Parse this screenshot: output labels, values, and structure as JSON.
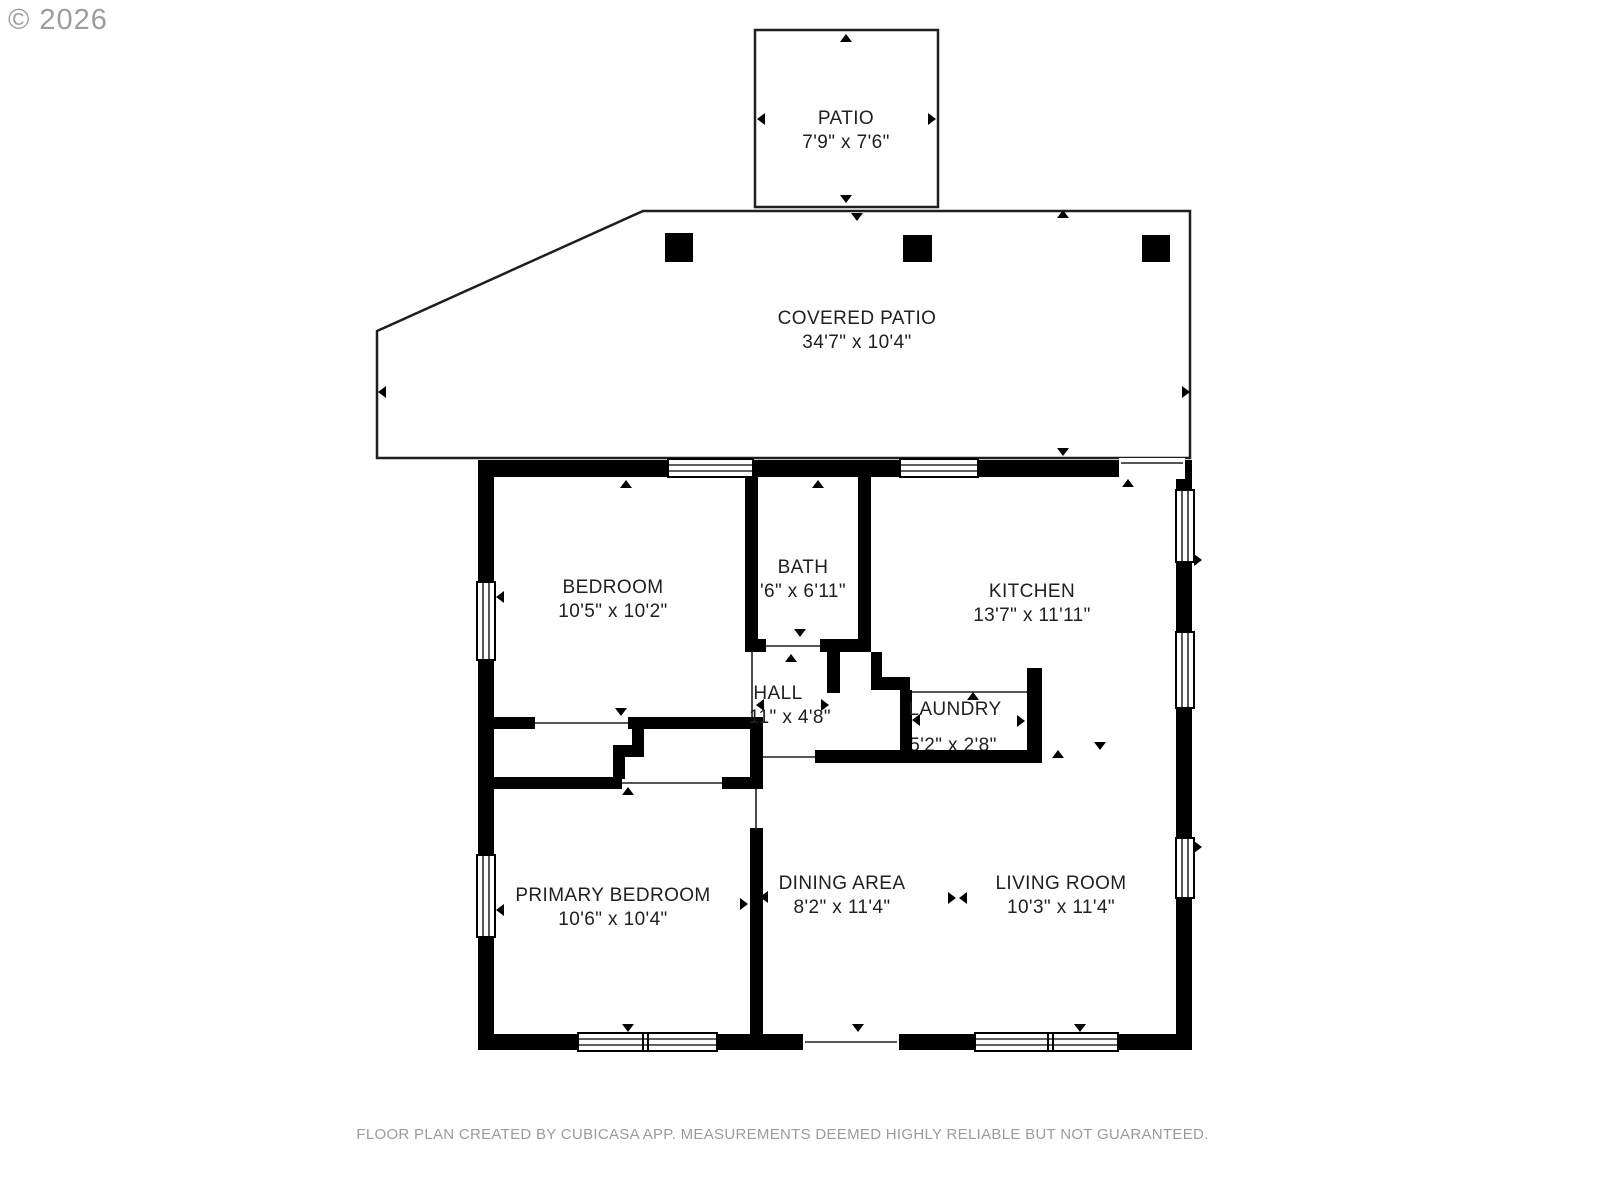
{
  "copyright": "© 2026",
  "footer": "FLOOR PLAN CREATED BY CUBICASA APP. MEASUREMENTS DEEMED HIGHLY RELIABLE BUT NOT GUARANTEED.",
  "colors": {
    "wall": "#000000",
    "outline": "#1f1f1f",
    "text": "#202020",
    "muted": "#9b9b9b",
    "copyright": "#8c8c8c"
  },
  "rooms": [
    {
      "id": "patio",
      "name": "PATIO",
      "dims": "7'9\" x 7'6\""
    },
    {
      "id": "covered-patio",
      "name": "COVERED PATIO",
      "dims": "34'7\" x 10'4\""
    },
    {
      "id": "bedroom",
      "name": "BEDROOM",
      "dims": "10'5\" x 10'2\""
    },
    {
      "id": "bath",
      "name": "BATH",
      "dims": "'6\" x 6'11\""
    },
    {
      "id": "kitchen",
      "name": "KITCHEN",
      "dims": "13'7\" x 11'11\""
    },
    {
      "id": "hall",
      "name": "HALL",
      "dims": "11\" x 4'8\""
    },
    {
      "id": "laundry",
      "name": "LAUNDRY",
      "dims": "5'2\" x 2'8\""
    },
    {
      "id": "primary-bedroom",
      "name": "PRIMARY BEDROOM",
      "dims": "10'6\" x 10'4\""
    },
    {
      "id": "dining-area",
      "name": "DINING AREA",
      "dims": "8'2\" x 11'4\""
    },
    {
      "id": "living-room",
      "name": "LIVING ROOM",
      "dims": "10'3\" x 11'4\""
    }
  ]
}
